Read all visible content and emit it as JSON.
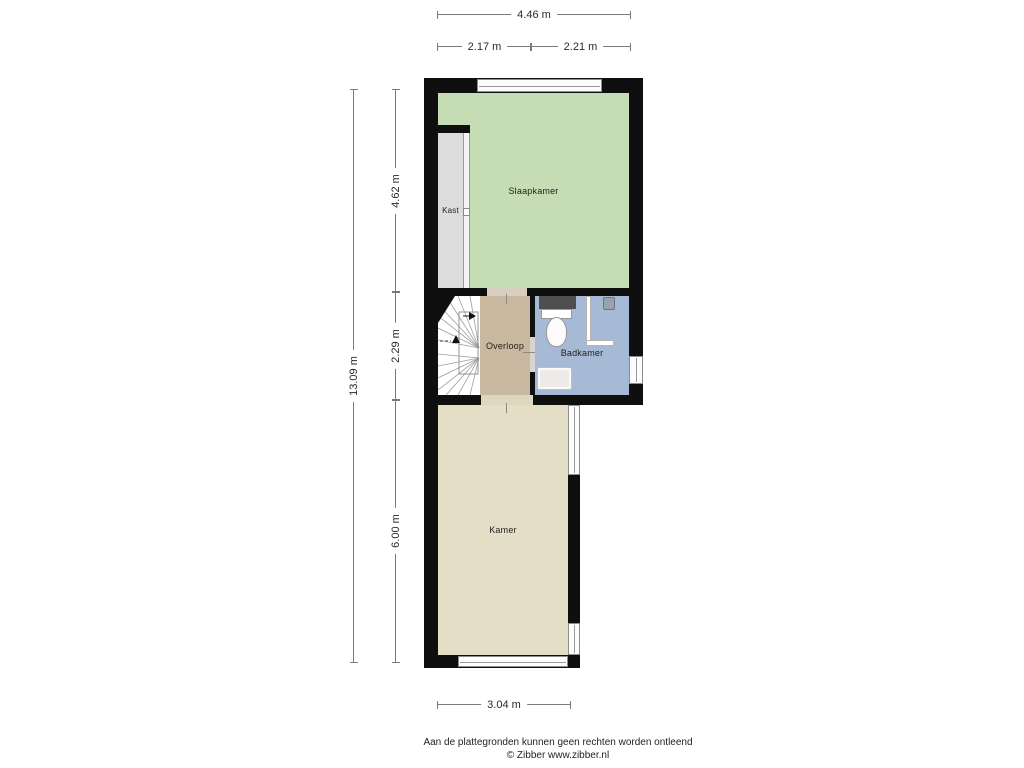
{
  "rooms": {
    "slaapkamer": {
      "label": "Slaapkamer"
    },
    "kast": {
      "label": "Kast"
    },
    "overloop": {
      "label": "Overloop"
    },
    "badkamer": {
      "label": "Badkamer"
    },
    "kamer": {
      "label": "Kamer"
    }
  },
  "dimensions": {
    "top_total": "4.46 m",
    "top_left": "2.17 m",
    "top_right": "2.21 m",
    "left_total": "13.09 m",
    "left_top": "4.62 m",
    "left_middle": "2.29 m",
    "left_bottom": "6.00 m",
    "bottom": "3.04 m"
  },
  "footer": {
    "line1": "Aan de plattegronden kunnen geen rechten worden ontleend",
    "line2": "© Zibber www.zibber.nl"
  },
  "colors": {
    "wall": "#0f0f0f",
    "dim_line": "#7a7a7a",
    "slaapkamer": "#c6dcb4",
    "kast": "#dcdcdc",
    "overloop": "#c9b8a0",
    "badkamer": "#a6bad6",
    "kamer": "#e5dec6"
  }
}
